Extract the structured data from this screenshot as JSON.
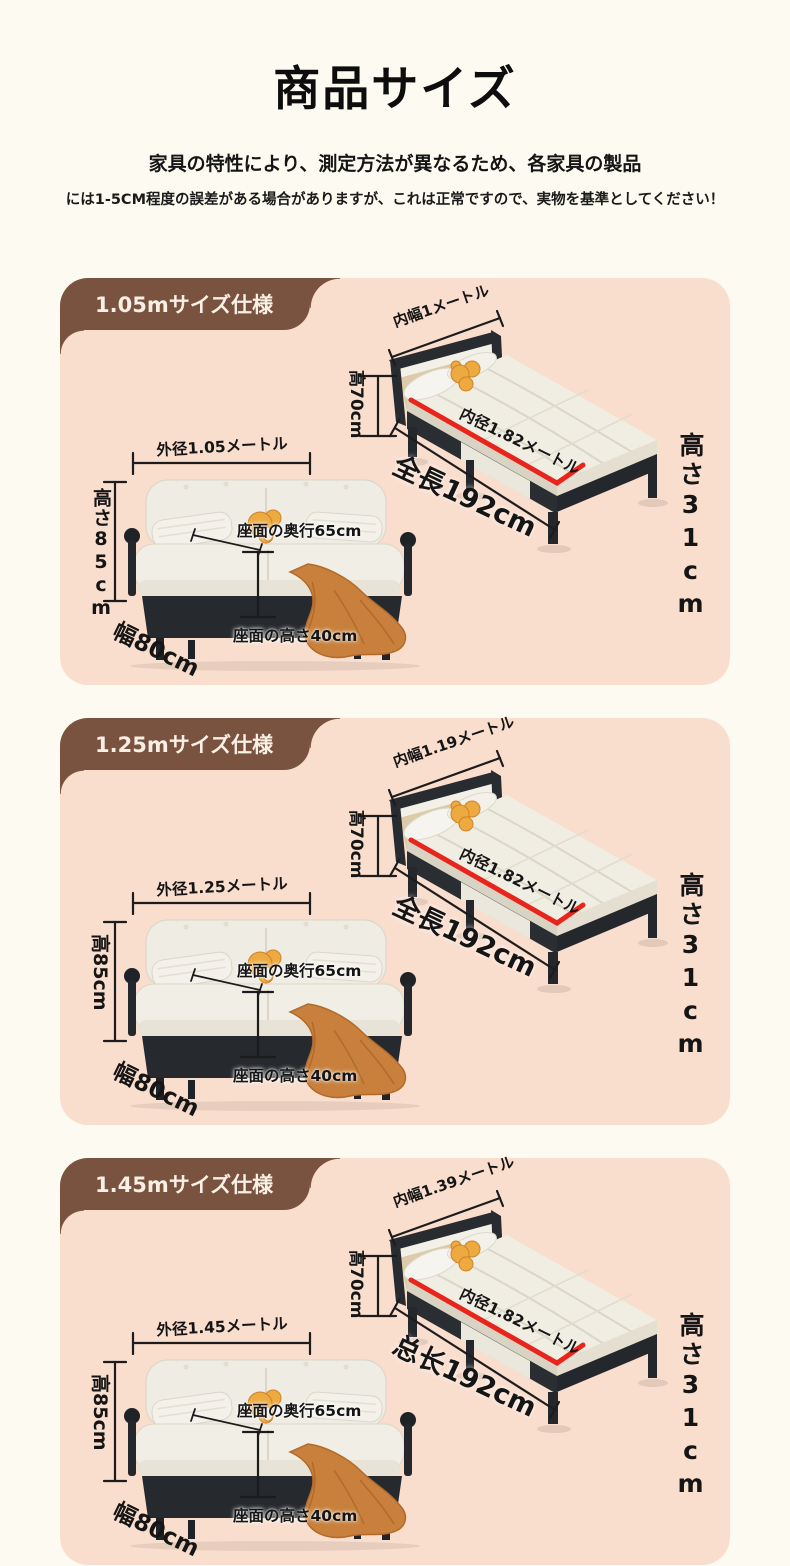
{
  "header": {
    "title": "商品サイズ",
    "subtitle1": "家具の特性により、測定方法が異なるため、各家具の製品",
    "subtitle2": "には1-5CM程度の誤差がある場合がありますが、これは正常ですので、実物を基準としてください！"
  },
  "colors": {
    "page_bg": "#fdfbf1",
    "panel_bg": "#f9ddcd",
    "tab_bg": "#7a5340",
    "tab_text": "#f8efe5",
    "accent_red": "#e8251c",
    "ink": "#1c1c1c"
  },
  "sections": [
    {
      "tab": "1.05mサイズ仕様",
      "bed": {
        "inner_width": "内幅1メートル",
        "head_height": "高70cm",
        "inner_length": "内径1.82メートル",
        "total_length": "全長192cm",
        "frame_height": "高さ31cm"
      },
      "sofa": {
        "outer_width": "外径1.05メートル",
        "height": "高さ85cm",
        "seat_depth": "座面の奥行65cm",
        "seat_height": "座面の高さ40cm",
        "width": "幅80cm"
      }
    },
    {
      "tab": "1.25mサイズ仕様",
      "bed": {
        "inner_width": "内幅1.19メートル",
        "head_height": "高70cm",
        "inner_length": "内径1.82メートル",
        "total_length": "全長192cm",
        "frame_height": "高さ31cm"
      },
      "sofa": {
        "outer_width": "外径1.25メートル",
        "height": "高85cm",
        "seat_depth": "座面の奥行65cm",
        "seat_height": "座面の高さ40cm",
        "width": "幅80cm"
      }
    },
    {
      "tab": "1.45mサイズ仕様",
      "bed": {
        "inner_width": "内幅1.39メートル",
        "head_height": "高70cm",
        "inner_length": "内径1.82メートル",
        "total_length": "总长192cm",
        "frame_height": "高さ31cm"
      },
      "sofa": {
        "outer_width": "外径1.45メートル",
        "height": "高85cm",
        "seat_depth": "座面の奥行65cm",
        "seat_height": "座面の高さ40cm",
        "width": "幅80cm"
      }
    }
  ]
}
